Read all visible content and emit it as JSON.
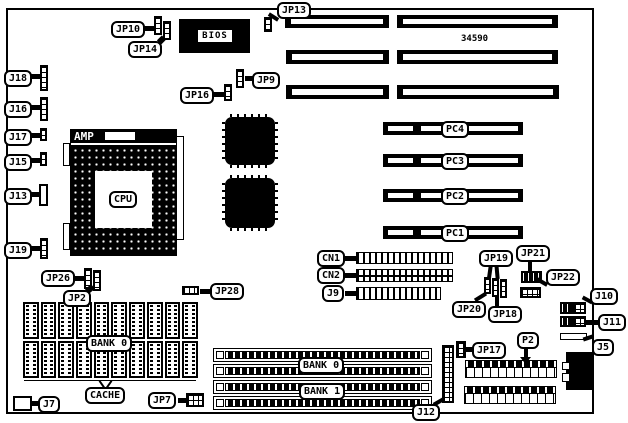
{
  "board": {
    "part_number": "34590"
  },
  "labels": {
    "jp10": "JP10",
    "jp14": "JP14",
    "jp13": "JP13",
    "jp16": "JP16",
    "jp9": "JP9",
    "j18": "J18",
    "j16": "J16",
    "j17": "J17",
    "j15": "J15",
    "j13": "J13",
    "j19": "J19",
    "bios": "BIOS",
    "amp": "AMP",
    "cpu": "CPU",
    "pc4": "PC4",
    "pc3": "PC3",
    "pc2": "PC2",
    "pc1": "PC1",
    "cn1": "CN1",
    "cn2": "CN2",
    "j9": "J9",
    "jp26": "JP26",
    "jp2": "JP2",
    "jp28": "JP28",
    "cache_bank0": "BANK 0",
    "cache": "CACHE",
    "j7": "J7",
    "jp7": "JP7",
    "simm_bank0": "BANK 0",
    "simm_bank1": "BANK 1",
    "j12": "J12",
    "jp19": "JP19",
    "jp20": "JP20",
    "jp18": "JP18",
    "jp21": "JP21",
    "jp22": "JP22",
    "j10": "J10",
    "j11": "J11",
    "j5": "J5",
    "jp17": "JP17",
    "p2": "P2"
  },
  "colors": {
    "ink": "#000000",
    "paper": "#ffffff"
  }
}
